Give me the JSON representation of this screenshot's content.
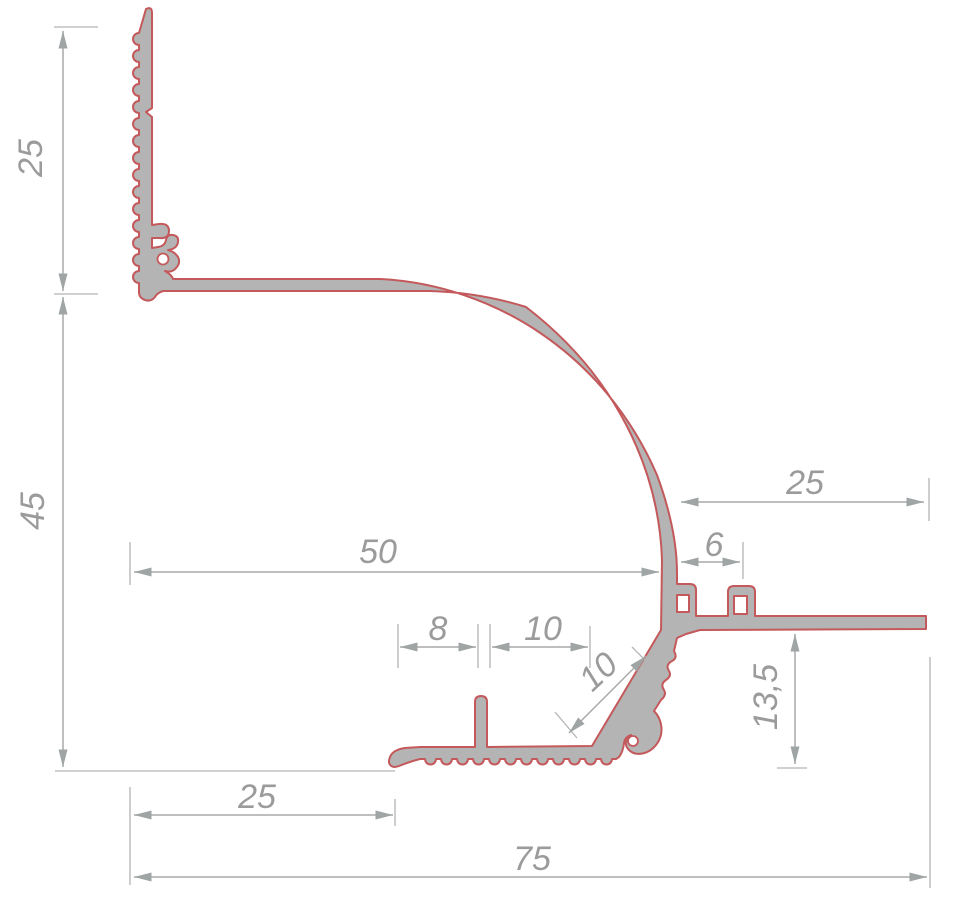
{
  "drawing": {
    "colors": {
      "profile_fill": "#b4b4b4",
      "profile_outline": "#c4595c",
      "dimension_line": "#a8a8a8",
      "dimension_text": "#9b9b9b",
      "background": "#ffffff"
    },
    "dimensions": {
      "left_top": "25",
      "left_height": "45",
      "inner_width": "50",
      "right_top_width": "25",
      "hook_offset": "6",
      "base_a": "8",
      "base_b": "10",
      "chamfer": "10",
      "right_depth": "13,5",
      "base_left": "25",
      "total_width": "75"
    }
  }
}
